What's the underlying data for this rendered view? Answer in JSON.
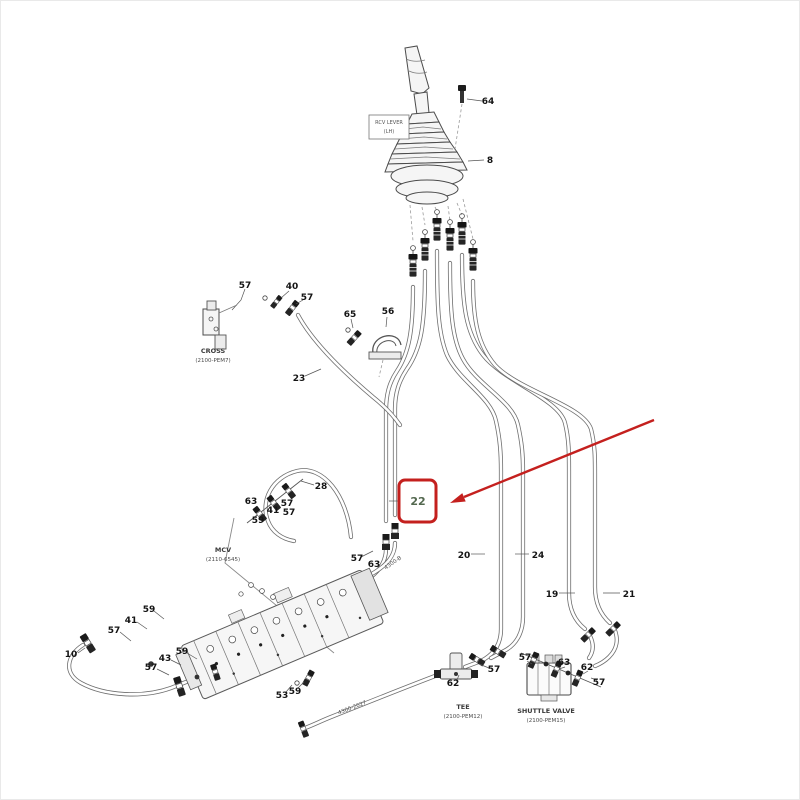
{
  "annotation": {
    "highlighted_part": "22",
    "accent_color": "#c4201e"
  },
  "labels": {
    "rcv_box_line1": "RCV LEVER",
    "rcv_box_line2": "(LH)",
    "cross_line1": "CROSS",
    "cross_line2": "(2100-PEM7)",
    "mcv_line1": "MCV",
    "mcv_line2": "(2110-6545)",
    "tee_line1": "TEE",
    "tee_line2": "(2100-PEM12)",
    "shuttle_line1": "SHUTTLE VALVE",
    "shuttle_line2": "(2100-PEM15)",
    "hose_code_a": "4300-B",
    "hose_code_b": "4300-2027"
  },
  "callouts": {
    "c64": "64",
    "c8": "8",
    "c57_cross": "57",
    "c40": "40",
    "c57_cross2": "57",
    "c65": "65",
    "c56": "56",
    "c23": "23",
    "c28": "28",
    "c63_loop": "63",
    "c57_loop": "57",
    "c41_loop": "41",
    "c57_loop2": "57",
    "c59_loop": "59",
    "c57_hose22": "57",
    "c63_hose22": "63",
    "c20": "20",
    "c24": "24",
    "c19": "19",
    "c21": "21",
    "c59_left": "59",
    "c41_left": "41",
    "c57_left": "57",
    "c10": "10",
    "c59_mid": "59",
    "c43": "43",
    "c57_mid": "57",
    "c53": "53",
    "c59_bottom": "59",
    "c62_tee": "62",
    "c57_tee": "57",
    "c57_shuttle": "57",
    "c63_shuttle": "63",
    "c62_shuttle": "62",
    "c57_shuttle2": "57"
  }
}
